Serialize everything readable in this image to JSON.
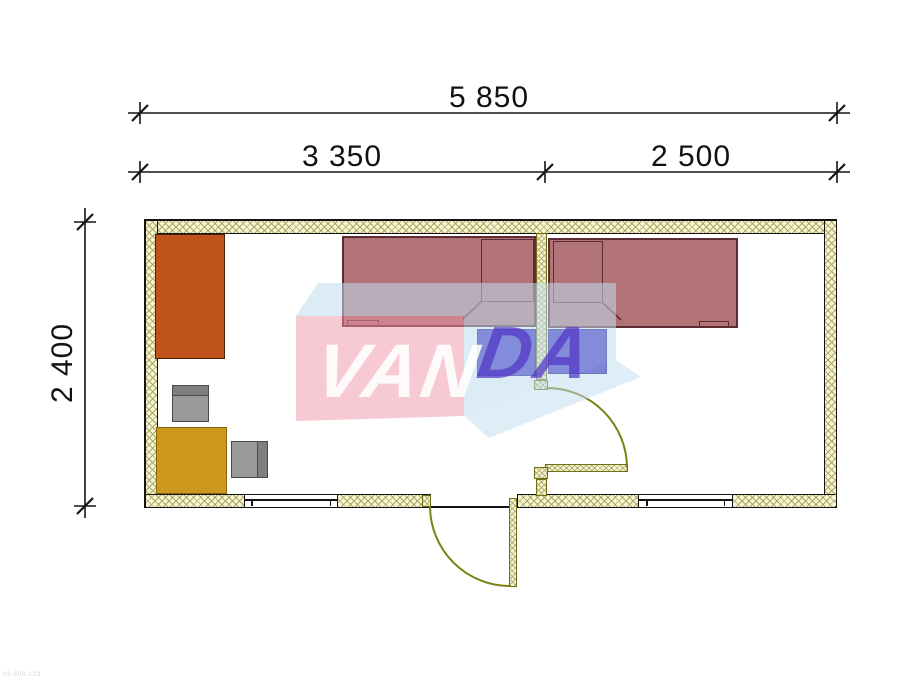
{
  "stamp": "01.600.123",
  "dimensions": {
    "overall_width": "5 850",
    "section_left": "3 350",
    "section_right": "2 500",
    "overall_depth": "2 400"
  },
  "watermark": {
    "full_name": "VANDA",
    "front_text": "VAN",
    "side_text": "DA",
    "pink": "#ef94a8",
    "light_blue": "#bfdcf0",
    "front_letter_color": "#ffffff",
    "side_letter_color": "#5334c5"
  },
  "plan": {
    "wall_fill": "#f8f4d8",
    "wall_hatch_color": "#a8a659",
    "wall_outline_color": "#141414",
    "partition_outline_color": "#6e6e14",
    "door_color": "#7a8212",
    "furniture_colors": {
      "wardrobe": "#c0521c",
      "desk": "#cc981e",
      "chair": "#9a9a9a",
      "bed": "#b17376",
      "bed_outline": "#5c2b33",
      "nightstand": "#392bc2"
    }
  }
}
